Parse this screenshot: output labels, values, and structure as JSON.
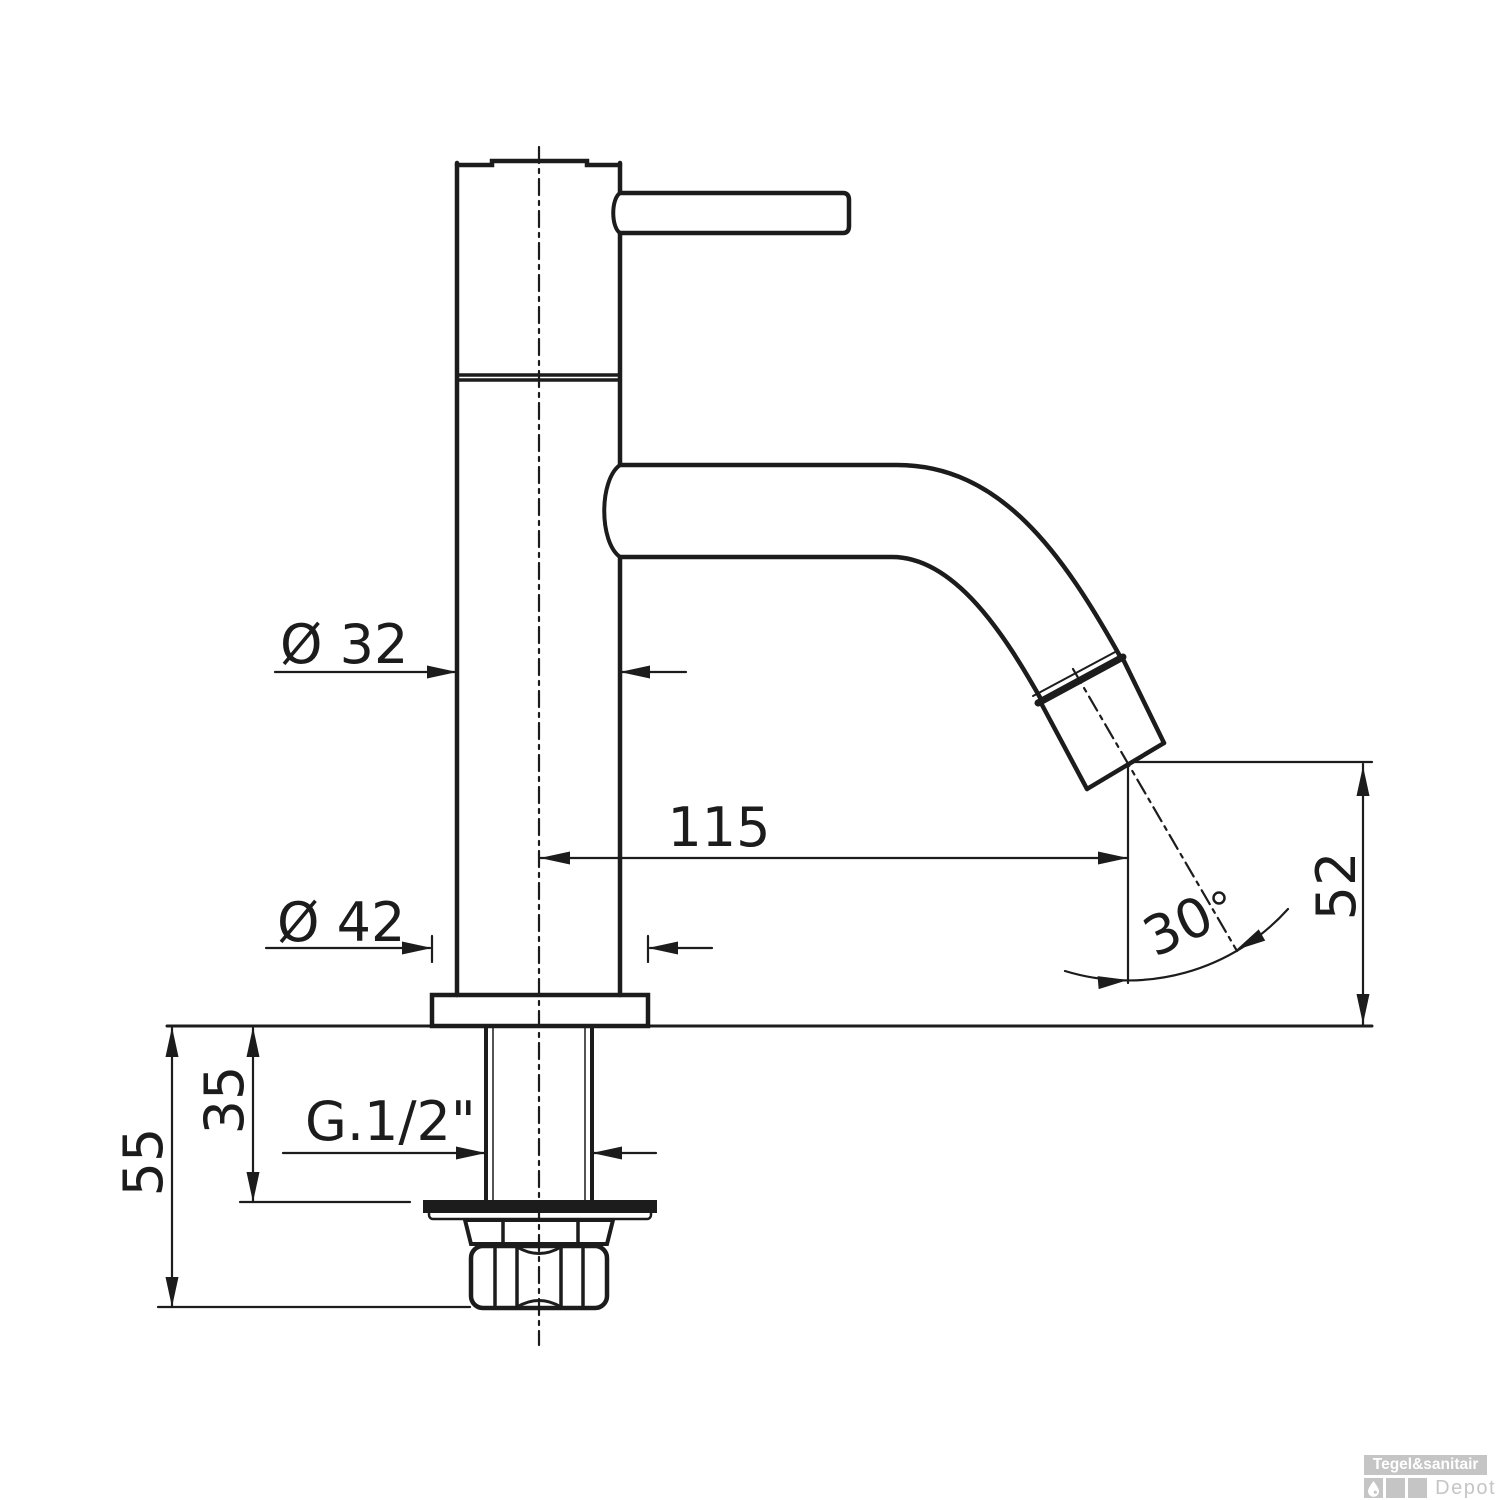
{
  "drawing": {
    "title": "cold-water-pillar-tap-dimensional-drawing",
    "dimensions": {
      "body_diameter_label": "Ø 32",
      "base_diameter_label": "Ø 42",
      "spout_reach_label": "115",
      "spout_height_label": "52",
      "spout_angle_label": "30",
      "angle_unit": "°",
      "shank_visible_label": "35",
      "shank_total_label": "55",
      "thread_label": "G.1/2\""
    },
    "colors": {
      "line": "#1c1c1c",
      "watermark_gray": "#c5c5c5",
      "background": "#ffffff"
    }
  },
  "watermark": {
    "brand": "Tegel&sanitair",
    "sub_brand": "Depot"
  }
}
